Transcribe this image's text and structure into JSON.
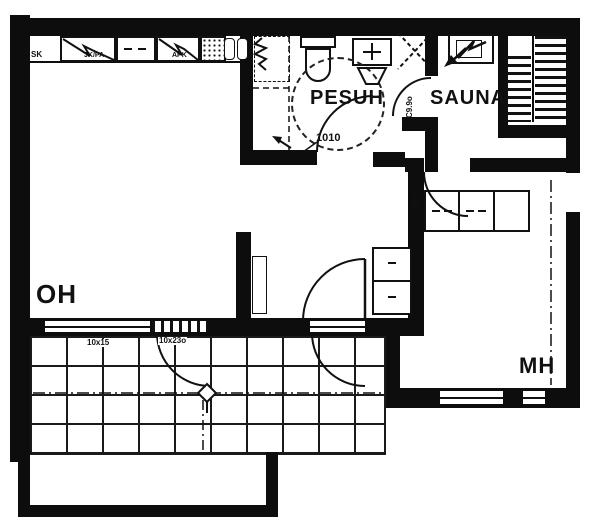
{
  "title": "apartment floor plan",
  "colors": {
    "ink": "#111111",
    "paper": "#ffffff"
  },
  "rooms": {
    "living": "OH",
    "washroom": "PESUH",
    "sauna": "SAUNA",
    "bedroom": "MH"
  },
  "markings": {
    "washroom_door": "1010",
    "sauna_door": "C9.9o",
    "bedroom_door": "09o",
    "living_window": "10x15",
    "balcony_door": "10x23o",
    "kitchen_left": "SK",
    "fridge_freezer": "JK/PA",
    "dishwasher": "APK"
  }
}
